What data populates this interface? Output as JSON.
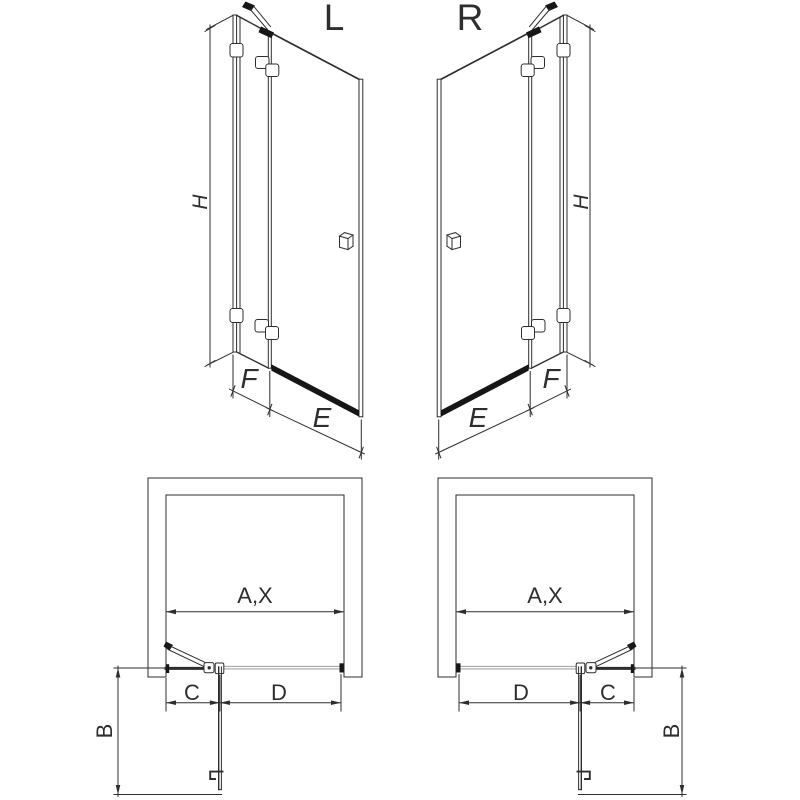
{
  "colors": {
    "background": "#ffffff",
    "line": "#2e2e2e",
    "dark_fill": "#161616",
    "phantom_line": "#a8a8a8"
  },
  "views": {
    "elevation_left": {
      "variant_label": "L",
      "height_dim_label": "H",
      "fixed_section_dim_label": "F",
      "door_section_dim_label": "E"
    },
    "elevation_right": {
      "variant_label": "R",
      "height_dim_label": "H",
      "fixed_section_dim_label": "F",
      "door_section_dim_label": "E"
    },
    "plan_left": {
      "opening_width_dim_label": "A,X",
      "door_swing_dim_label": "B",
      "fixed_section_dim_label": "C",
      "door_section_dim_label": "D"
    },
    "plan_right": {
      "opening_width_dim_label": "A,X",
      "door_swing_dim_label": "B",
      "fixed_section_dim_label": "C",
      "door_section_dim_label": "D"
    }
  }
}
